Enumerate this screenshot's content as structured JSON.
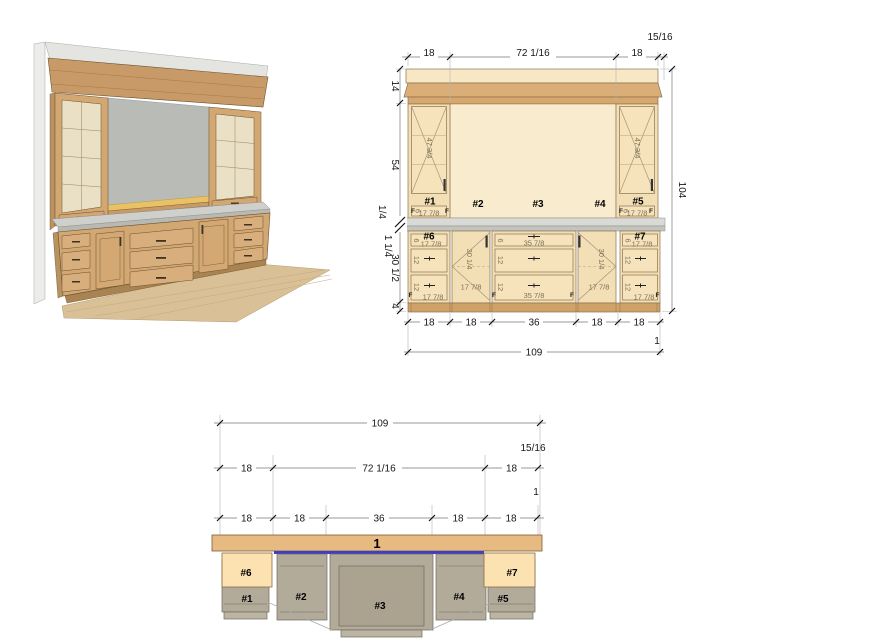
{
  "views": {
    "elevation": {
      "top_dims": [
        "18",
        "72 1/16",
        "18"
      ],
      "top_offset": "15/16",
      "left_dims": [
        "14",
        "54",
        "1/4",
        "1 1/4",
        "30 1/2",
        "4"
      ],
      "total_height": "104",
      "bottom_dims": [
        "18",
        "18",
        "36",
        "18",
        "18"
      ],
      "bottom_offset": "1",
      "total_width": "109",
      "labels": [
        "#1",
        "#2",
        "#3",
        "#4",
        "#5",
        "#6",
        "#7"
      ],
      "door_height": "47 3/4",
      "opening_small": "17 7/8",
      "opening_wide": "35 7/8",
      "door_opening": "30 1/4",
      "drawer_height": "12",
      "top_drawer_height": "6",
      "finished_end": "F"
    },
    "plan": {
      "total_width": "109",
      "back_offset": "15/16",
      "upper_dims": [
        "18",
        "72 1/16",
        "18"
      ],
      "side_offset": "1",
      "lower_dims": [
        "18",
        "18",
        "36",
        "18",
        "18"
      ],
      "countertop": "1",
      "labels": [
        "#6",
        "#7",
        "#1",
        "#2",
        "#3",
        "#4",
        "#5"
      ]
    }
  },
  "colors": {
    "accent_blue": "#3d3dc8",
    "wood": "#d2a772",
    "countertop_tan": "#e7ba82",
    "counter_gray": "#d9d9d5",
    "cream": "#f9ecce"
  }
}
